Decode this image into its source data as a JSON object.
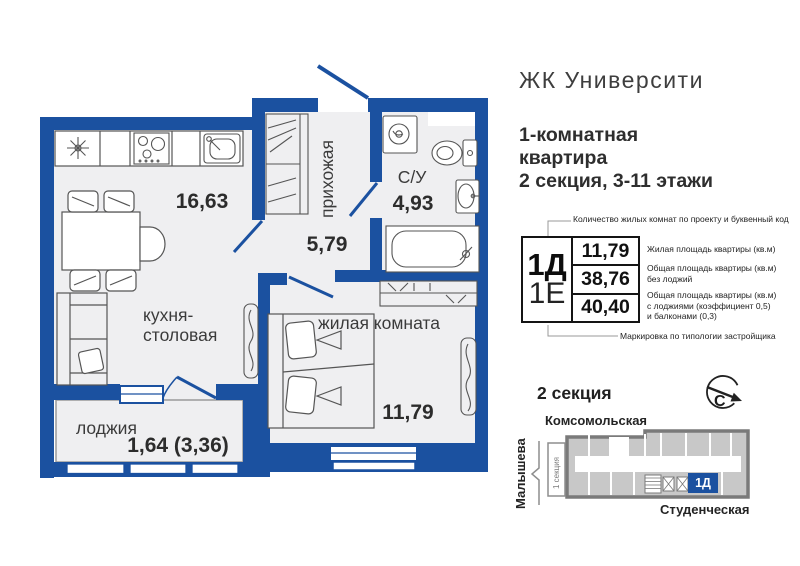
{
  "header": {
    "title": "ЖК Университи",
    "subtitle_lines": [
      "1-комнатная",
      "квартира",
      "2 секция, 3-11 этажи"
    ]
  },
  "plan": {
    "kitchen": {
      "label_lines": [
        "кухня-",
        "столовая"
      ],
      "area": "16,63"
    },
    "hallway": {
      "label": "прихожая",
      "area": "5,79"
    },
    "bathroom": {
      "label": "С/У",
      "area": "4,93"
    },
    "living_room": {
      "label": "жилая комната",
      "area": "11,79"
    },
    "loggia": {
      "label": "лоджия",
      "area": "1,64 (3,36)"
    }
  },
  "info_table": {
    "room_count_code": "1Д",
    "typology_code": "1Е",
    "top_note": "Количество жилых комнат по проекту и буквенный код",
    "bottom_note": "Маркировка по типологии застройщика",
    "rows": [
      {
        "value": "11,79",
        "note_lines": [
          "Жилая площадь квартиры (кв.м)"
        ]
      },
      {
        "value": "38,76",
        "note_lines": [
          "Общая площадь квартиры (кв.м)",
          "без лоджий"
        ]
      },
      {
        "value": "40,40",
        "note_lines": [
          "Общая площадь квартиры (кв.м)",
          "с лоджиями (коэффициент 0,5)",
          "и балконами (0,3)"
        ]
      }
    ]
  },
  "minimap": {
    "section_title": "2 секция",
    "compass_letter": "С",
    "street_top": "Комсомольская",
    "street_left": "Малышева",
    "street_bottom": "Студенческая",
    "section1_label": "1 секция",
    "unit_label": "1Д"
  },
  "colors": {
    "wall_blue": "#1b51a0",
    "floor_fill": "#efeff1",
    "map_gray": "#7a7a7a",
    "unit_blue": "#1b51a0"
  }
}
